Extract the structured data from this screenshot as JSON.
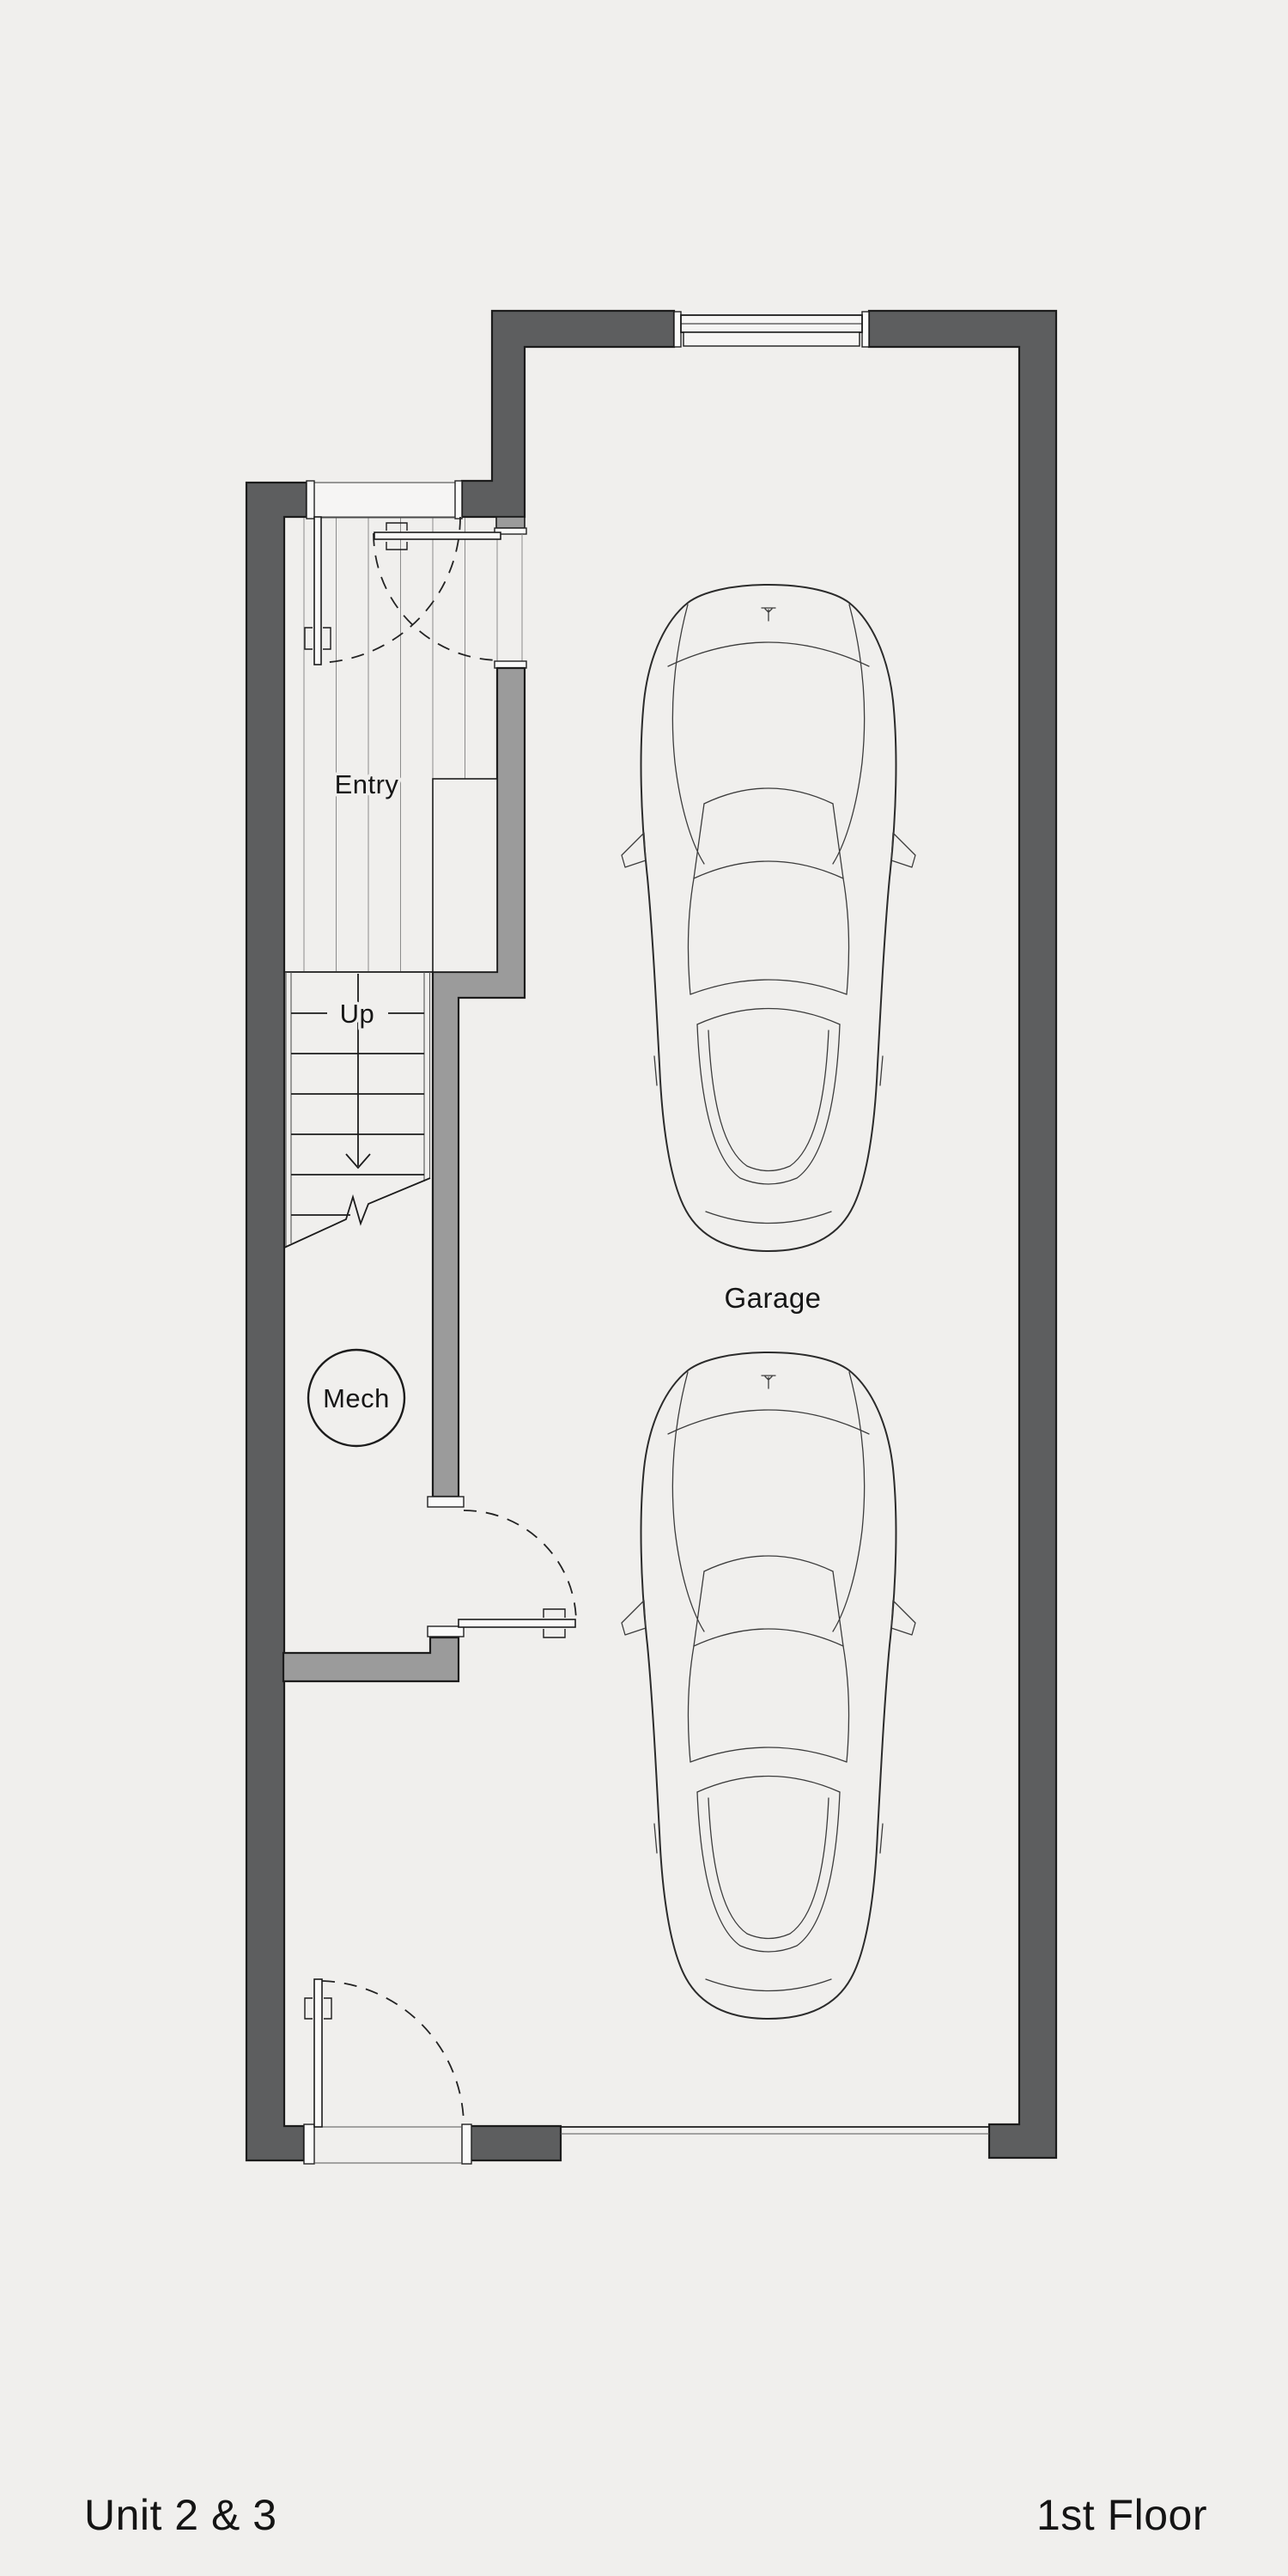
{
  "page": {
    "type": "architectural floor plan",
    "unit_label": "Unit 2 & 3",
    "floor_label": "1st Floor"
  },
  "plan": {
    "room_labels": {
      "entry": "Entry",
      "stairs_direction": "Up",
      "mechanical": "Mech",
      "garage": "Garage"
    },
    "cars_in_garage": 2
  },
  "colors": {
    "background": "#f0efed",
    "wall_dark": "#5d5e5f",
    "wall_medium": "#9b9b9b",
    "line": "#1c1c1c",
    "text": "#161616"
  }
}
